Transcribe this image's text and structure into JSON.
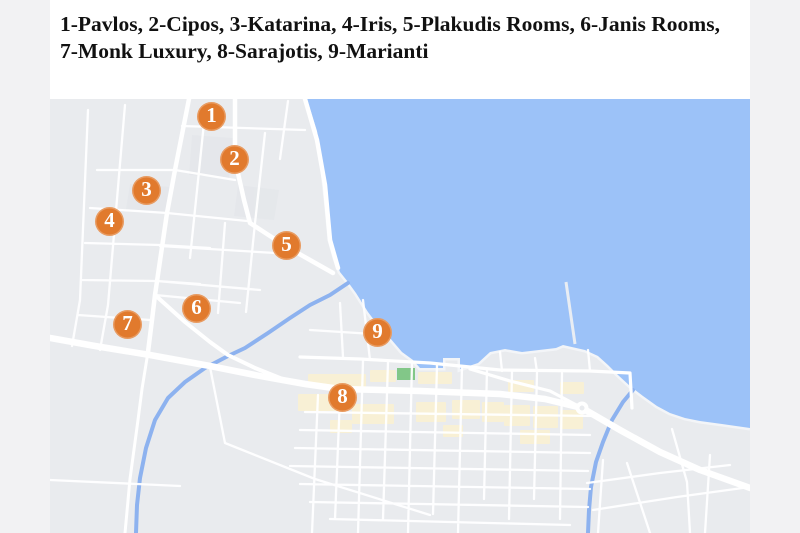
{
  "legend": {
    "line1": "1-Pavlos, 2-Cipos, 3-Katarina, 4-Iris, 5-Plakudis Rooms, 6-Janis Rooms,",
    "line2": "7-Monk Luxury, 8-Sarajotis, 9-Marianti",
    "items": [
      {
        "number": "1",
        "name": "Pavlos"
      },
      {
        "number": "2",
        "name": "Cipos"
      },
      {
        "number": "3",
        "name": "Katarina"
      },
      {
        "number": "4",
        "name": "Iris"
      },
      {
        "number": "5",
        "name": "Plakudis Rooms"
      },
      {
        "number": "6",
        "name": "Janis Rooms"
      },
      {
        "number": "7",
        "name": "Monk Luxury"
      },
      {
        "number": "8",
        "name": "Sarajotis"
      },
      {
        "number": "9",
        "name": "Marianti"
      }
    ]
  },
  "map": {
    "colors": {
      "page_bg": "#f2f2f3",
      "header_bg": "#ffffff",
      "text": "#111111",
      "land": "#e9ebee",
      "water": "#9cc2f8",
      "road": "#ffffff",
      "river": "#8db2ef",
      "commercial": "#f8f0d5",
      "park": "#82c788",
      "marker": "#e17a2d",
      "marker_text": "#ffffff"
    },
    "markers": [
      {
        "number": "1",
        "name": "Pavlos",
        "x": 162,
        "y": 18
      },
      {
        "number": "2",
        "name": "Cipos",
        "x": 185,
        "y": 61
      },
      {
        "number": "3",
        "name": "Katarina",
        "x": 97,
        "y": 92
      },
      {
        "number": "4",
        "name": "Iris",
        "x": 60,
        "y": 123
      },
      {
        "number": "5",
        "name": "Plakudis Rooms",
        "x": 237,
        "y": 147
      },
      {
        "number": "6",
        "name": "Janis Rooms",
        "x": 147,
        "y": 210
      },
      {
        "number": "7",
        "name": "Monk Luxury",
        "x": 78,
        "y": 226
      },
      {
        "number": "8",
        "name": "Sarajotis",
        "x": 293,
        "y": 299
      },
      {
        "number": "9",
        "name": "Marianti",
        "x": 328,
        "y": 234
      }
    ]
  }
}
